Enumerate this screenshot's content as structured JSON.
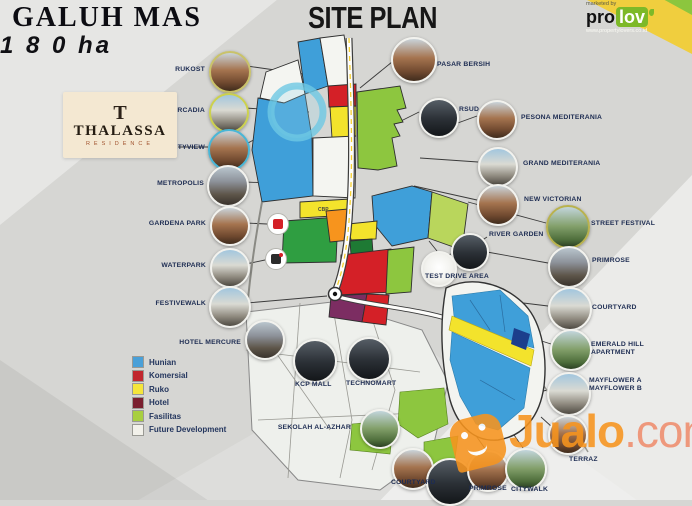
{
  "header": {
    "project_name": "GALUH MAS",
    "project_area": "1 8 0 ha",
    "plan_title": "SITE PLAN"
  },
  "prolov": {
    "tagline": "marketed by",
    "brand_left": "pro",
    "brand_right": "lov",
    "website": "www.propertylovers.co.id"
  },
  "thalassa": {
    "monogram": "T",
    "name": "THALASSA",
    "subtitle": "RESIDENCE"
  },
  "map": {
    "cbp_label": "CBP"
  },
  "legend": {
    "items": [
      {
        "label": "Hunian",
        "color": "#4aa0d8"
      },
      {
        "label": "Komersial",
        "color": "#c1272d"
      },
      {
        "label": "Ruko",
        "color": "#f5e63a"
      },
      {
        "label": "Hotel",
        "color": "#7a1f2e"
      },
      {
        "label": "Fasilitas",
        "color": "#a8cf3f"
      },
      {
        "label": "Future Development",
        "color": "#f2f1ea"
      }
    ]
  },
  "watermark": {
    "brand": "Jualo",
    "suffix": ".com"
  },
  "callouts": [
    {
      "id": "rukost",
      "label": "RUKOST"
    },
    {
      "id": "arcadia",
      "label": "ARCADIA"
    },
    {
      "id": "cityview",
      "label": "CITYVIEW"
    },
    {
      "id": "metropolis",
      "label": "METROPOLIS"
    },
    {
      "id": "gardena-park",
      "label": "GARDENA PARK"
    },
    {
      "id": "waterpark",
      "label": "WATERPARK"
    },
    {
      "id": "festivewalk",
      "label": "FESTIVEWALK"
    },
    {
      "id": "hotel-mercure",
      "label": "HOTEL MERCURE"
    },
    {
      "id": "pasar-bersih",
      "label": "PASAR BERSIH"
    },
    {
      "id": "rsud",
      "label": "RSUD"
    },
    {
      "id": "pesona-mediterania",
      "label": "PESONA MEDITERANIA"
    },
    {
      "id": "grand-mediterania",
      "label": "GRAND MEDITERANIA"
    },
    {
      "id": "new-victorian",
      "label": "NEW VICTORIAN"
    },
    {
      "id": "street-festival",
      "label": "STREET FESTIVAL"
    },
    {
      "id": "river-garden",
      "label": "RIVER GARDEN"
    },
    {
      "id": "test-drive-area",
      "label": "TEST DRIVE AREA"
    },
    {
      "id": "primrose-east",
      "label": "PRIMROSE"
    },
    {
      "id": "courtyard-east",
      "label": "COURTYARD"
    },
    {
      "id": "emerald-hill",
      "label": "EMERALD HILL",
      "label2": "APARTMENT"
    },
    {
      "id": "mayflower",
      "label": "MAYFLOWER A",
      "label2": "MAYFLOWER B"
    },
    {
      "id": "terraz",
      "label": "TERRAZ"
    },
    {
      "id": "kcp-mall",
      "label": "KCP MALL"
    },
    {
      "id": "technomart",
      "label": "TECHNOMART"
    },
    {
      "id": "sekolah-al-azhar",
      "label": "SEKOLAH AL-AZHAR"
    },
    {
      "id": "courtyard-south",
      "label": "COURTYARD"
    },
    {
      "id": "south-photo",
      "label": ""
    },
    {
      "id": "primrose-south",
      "label": "PRIMROSE"
    },
    {
      "id": "citywalk",
      "label": "CITYWALK"
    }
  ]
}
